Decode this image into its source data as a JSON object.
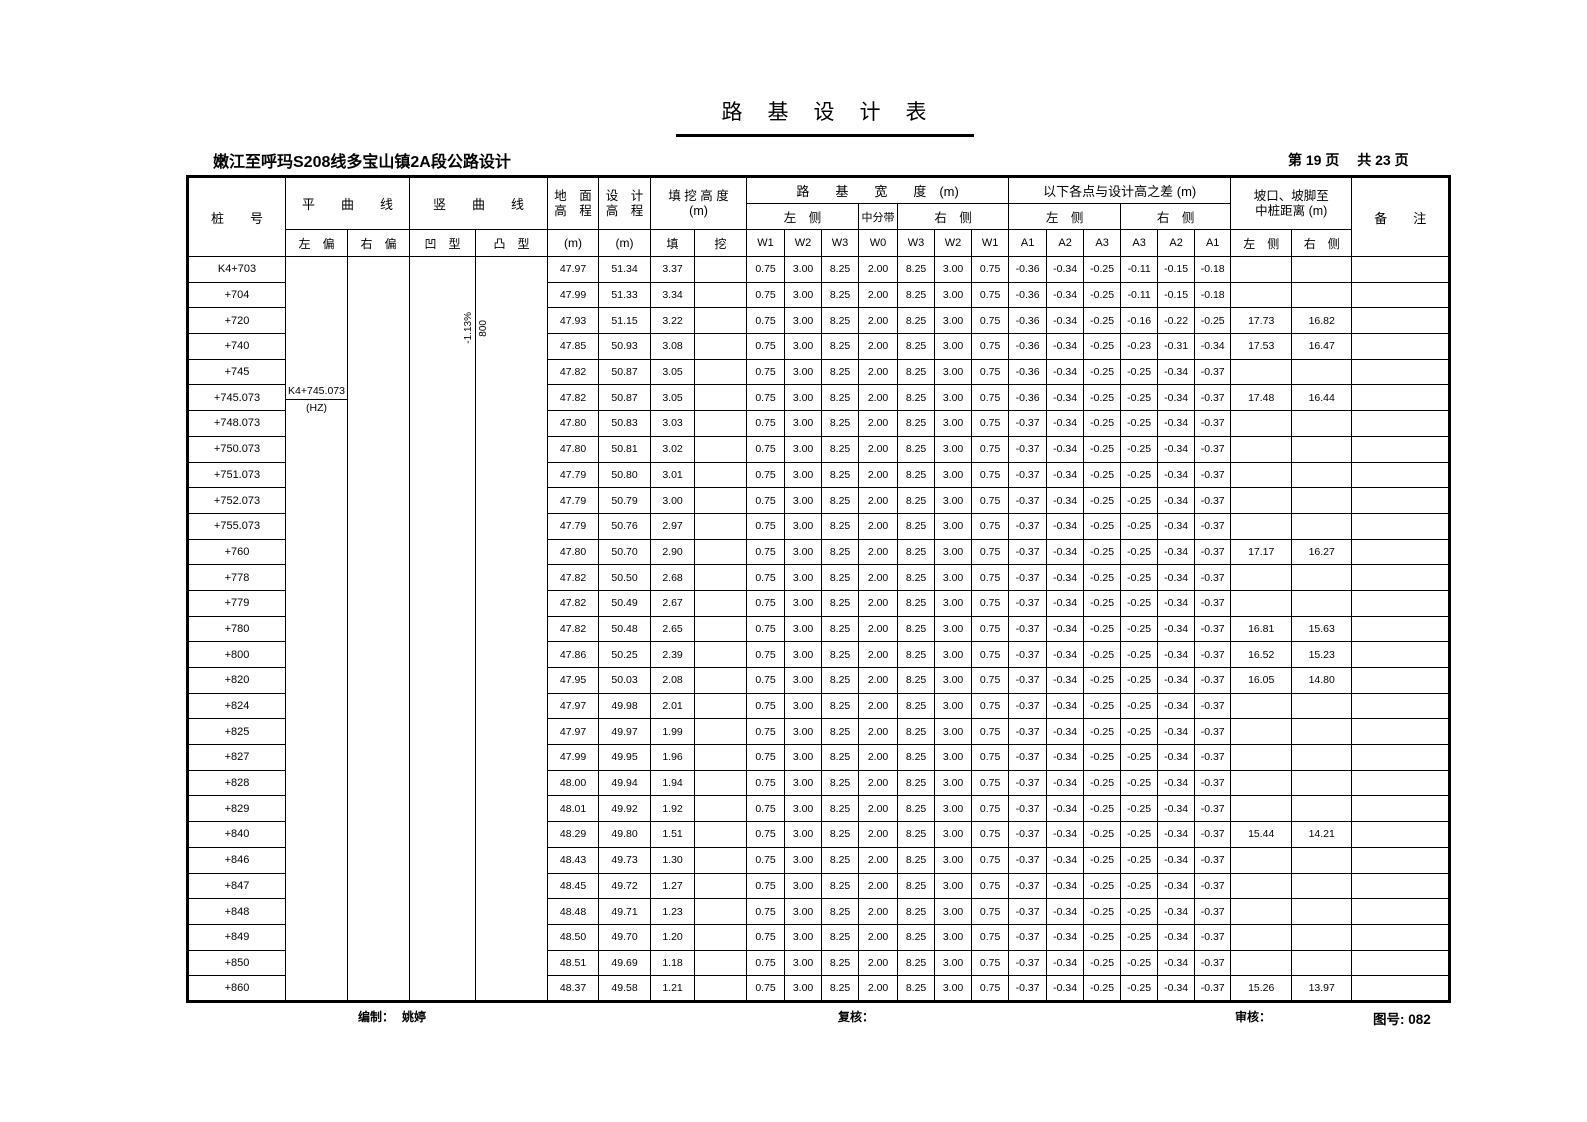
{
  "page": {
    "title": "路　基　设　计　表",
    "subtitle": "嫩江至呼玛S208线多宝山镇2A段公路设计",
    "page_info": "第 19 页　 共 23 页"
  },
  "header": {
    "stake": "桩　　号",
    "h_curve": "平　　曲　　线",
    "v_curve": "竖　　曲　　线",
    "curve_left": "左　偏",
    "curve_right": "右　偏",
    "concave": "凹　型",
    "convex": "凸　型",
    "ground_1": "地　面",
    "ground_2": "高　程",
    "design_1": "设　计",
    "design_2": "高　程",
    "unit_m": "(m)",
    "fillcut_1": "填 挖 高 度",
    "fillcut_2": "(m)",
    "fill": "填",
    "cut": "挖",
    "width_group": "路　　基　　宽　　度　(m)",
    "left_side": "左　侧",
    "median": "中分带",
    "right_side": "右　侧",
    "diff_group": "以下各点与设计高之差 (m)",
    "slope_1": "坡口、坡脚至",
    "slope_2": "中桩距离 (m)",
    "remark": "备　　注",
    "w_labels": [
      "W1",
      "W2",
      "W3",
      "W0",
      "W3",
      "W2",
      "W1"
    ],
    "a_labels": [
      "A1",
      "A2",
      "A3",
      "A3",
      "A2",
      "A1"
    ]
  },
  "annotations": {
    "hz_station": "K4+745.073",
    "hz_mark": "(HZ)",
    "vcurve_grade": "-1.13%",
    "vcurve_radius": "800"
  },
  "table": {
    "column_order": [
      "stake",
      "ground_elev_m",
      "design_elev_m",
      "fill",
      "cut",
      "W1_left",
      "W2_left",
      "W3_left",
      "W0_median",
      "W3_right",
      "W2_right",
      "W1_right",
      "A1_left",
      "A2_left",
      "A3_left",
      "A3_right",
      "A2_right",
      "A1_right",
      "slope_dist_left",
      "slope_dist_right",
      "remark"
    ],
    "rows": [
      [
        "K4+703",
        "47.97",
        "51.34",
        "3.37",
        "",
        "0.75",
        "3.00",
        "8.25",
        "2.00",
        "8.25",
        "3.00",
        "0.75",
        "-0.36",
        "-0.34",
        "-0.25",
        "-0.11",
        "-0.15",
        "-0.18",
        "",
        "",
        ""
      ],
      [
        "+704",
        "47.99",
        "51.33",
        "3.34",
        "",
        "0.75",
        "3.00",
        "8.25",
        "2.00",
        "8.25",
        "3.00",
        "0.75",
        "-0.36",
        "-0.34",
        "-0.25",
        "-0.11",
        "-0.15",
        "-0.18",
        "",
        "",
        ""
      ],
      [
        "+720",
        "47.93",
        "51.15",
        "3.22",
        "",
        "0.75",
        "3.00",
        "8.25",
        "2.00",
        "8.25",
        "3.00",
        "0.75",
        "-0.36",
        "-0.34",
        "-0.25",
        "-0.16",
        "-0.22",
        "-0.25",
        "17.73",
        "16.82",
        ""
      ],
      [
        "+740",
        "47.85",
        "50.93",
        "3.08",
        "",
        "0.75",
        "3.00",
        "8.25",
        "2.00",
        "8.25",
        "3.00",
        "0.75",
        "-0.36",
        "-0.34",
        "-0.25",
        "-0.23",
        "-0.31",
        "-0.34",
        "17.53",
        "16.47",
        ""
      ],
      [
        "+745",
        "47.82",
        "50.87",
        "3.05",
        "",
        "0.75",
        "3.00",
        "8.25",
        "2.00",
        "8.25",
        "3.00",
        "0.75",
        "-0.36",
        "-0.34",
        "-0.25",
        "-0.25",
        "-0.34",
        "-0.37",
        "",
        "",
        ""
      ],
      [
        "+745.073",
        "47.82",
        "50.87",
        "3.05",
        "",
        "0.75",
        "3.00",
        "8.25",
        "2.00",
        "8.25",
        "3.00",
        "0.75",
        "-0.36",
        "-0.34",
        "-0.25",
        "-0.25",
        "-0.34",
        "-0.37",
        "17.48",
        "16.44",
        ""
      ],
      [
        "+748.073",
        "47.80",
        "50.83",
        "3.03",
        "",
        "0.75",
        "3.00",
        "8.25",
        "2.00",
        "8.25",
        "3.00",
        "0.75",
        "-0.37",
        "-0.34",
        "-0.25",
        "-0.25",
        "-0.34",
        "-0.37",
        "",
        "",
        ""
      ],
      [
        "+750.073",
        "47.80",
        "50.81",
        "3.02",
        "",
        "0.75",
        "3.00",
        "8.25",
        "2.00",
        "8.25",
        "3.00",
        "0.75",
        "-0.37",
        "-0.34",
        "-0.25",
        "-0.25",
        "-0.34",
        "-0.37",
        "",
        "",
        ""
      ],
      [
        "+751.073",
        "47.79",
        "50.80",
        "3.01",
        "",
        "0.75",
        "3.00",
        "8.25",
        "2.00",
        "8.25",
        "3.00",
        "0.75",
        "-0.37",
        "-0.34",
        "-0.25",
        "-0.25",
        "-0.34",
        "-0.37",
        "",
        "",
        ""
      ],
      [
        "+752.073",
        "47.79",
        "50.79",
        "3.00",
        "",
        "0.75",
        "3.00",
        "8.25",
        "2.00",
        "8.25",
        "3.00",
        "0.75",
        "-0.37",
        "-0.34",
        "-0.25",
        "-0.25",
        "-0.34",
        "-0.37",
        "",
        "",
        ""
      ],
      [
        "+755.073",
        "47.79",
        "50.76",
        "2.97",
        "",
        "0.75",
        "3.00",
        "8.25",
        "2.00",
        "8.25",
        "3.00",
        "0.75",
        "-0.37",
        "-0.34",
        "-0.25",
        "-0.25",
        "-0.34",
        "-0.37",
        "",
        "",
        ""
      ],
      [
        "+760",
        "47.80",
        "50.70",
        "2.90",
        "",
        "0.75",
        "3.00",
        "8.25",
        "2.00",
        "8.25",
        "3.00",
        "0.75",
        "-0.37",
        "-0.34",
        "-0.25",
        "-0.25",
        "-0.34",
        "-0.37",
        "17.17",
        "16.27",
        ""
      ],
      [
        "+778",
        "47.82",
        "50.50",
        "2.68",
        "",
        "0.75",
        "3.00",
        "8.25",
        "2.00",
        "8.25",
        "3.00",
        "0.75",
        "-0.37",
        "-0.34",
        "-0.25",
        "-0.25",
        "-0.34",
        "-0.37",
        "",
        "",
        ""
      ],
      [
        "+779",
        "47.82",
        "50.49",
        "2.67",
        "",
        "0.75",
        "3.00",
        "8.25",
        "2.00",
        "8.25",
        "3.00",
        "0.75",
        "-0.37",
        "-0.34",
        "-0.25",
        "-0.25",
        "-0.34",
        "-0.37",
        "",
        "",
        ""
      ],
      [
        "+780",
        "47.82",
        "50.48",
        "2.65",
        "",
        "0.75",
        "3.00",
        "8.25",
        "2.00",
        "8.25",
        "3.00",
        "0.75",
        "-0.37",
        "-0.34",
        "-0.25",
        "-0.25",
        "-0.34",
        "-0.37",
        "16.81",
        "15.63",
        ""
      ],
      [
        "+800",
        "47.86",
        "50.25",
        "2.39",
        "",
        "0.75",
        "3.00",
        "8.25",
        "2.00",
        "8.25",
        "3.00",
        "0.75",
        "-0.37",
        "-0.34",
        "-0.25",
        "-0.25",
        "-0.34",
        "-0.37",
        "16.52",
        "15.23",
        ""
      ],
      [
        "+820",
        "47.95",
        "50.03",
        "2.08",
        "",
        "0.75",
        "3.00",
        "8.25",
        "2.00",
        "8.25",
        "3.00",
        "0.75",
        "-0.37",
        "-0.34",
        "-0.25",
        "-0.25",
        "-0.34",
        "-0.37",
        "16.05",
        "14.80",
        ""
      ],
      [
        "+824",
        "47.97",
        "49.98",
        "2.01",
        "",
        "0.75",
        "3.00",
        "8.25",
        "2.00",
        "8.25",
        "3.00",
        "0.75",
        "-0.37",
        "-0.34",
        "-0.25",
        "-0.25",
        "-0.34",
        "-0.37",
        "",
        "",
        ""
      ],
      [
        "+825",
        "47.97",
        "49.97",
        "1.99",
        "",
        "0.75",
        "3.00",
        "8.25",
        "2.00",
        "8.25",
        "3.00",
        "0.75",
        "-0.37",
        "-0.34",
        "-0.25",
        "-0.25",
        "-0.34",
        "-0.37",
        "",
        "",
        ""
      ],
      [
        "+827",
        "47.99",
        "49.95",
        "1.96",
        "",
        "0.75",
        "3.00",
        "8.25",
        "2.00",
        "8.25",
        "3.00",
        "0.75",
        "-0.37",
        "-0.34",
        "-0.25",
        "-0.25",
        "-0.34",
        "-0.37",
        "",
        "",
        ""
      ],
      [
        "+828",
        "48.00",
        "49.94",
        "1.94",
        "",
        "0.75",
        "3.00",
        "8.25",
        "2.00",
        "8.25",
        "3.00",
        "0.75",
        "-0.37",
        "-0.34",
        "-0.25",
        "-0.25",
        "-0.34",
        "-0.37",
        "",
        "",
        ""
      ],
      [
        "+829",
        "48.01",
        "49.92",
        "1.92",
        "",
        "0.75",
        "3.00",
        "8.25",
        "2.00",
        "8.25",
        "3.00",
        "0.75",
        "-0.37",
        "-0.34",
        "-0.25",
        "-0.25",
        "-0.34",
        "-0.37",
        "",
        "",
        ""
      ],
      [
        "+840",
        "48.29",
        "49.80",
        "1.51",
        "",
        "0.75",
        "3.00",
        "8.25",
        "2.00",
        "8.25",
        "3.00",
        "0.75",
        "-0.37",
        "-0.34",
        "-0.25",
        "-0.25",
        "-0.34",
        "-0.37",
        "15.44",
        "14.21",
        ""
      ],
      [
        "+846",
        "48.43",
        "49.73",
        "1.30",
        "",
        "0.75",
        "3.00",
        "8.25",
        "2.00",
        "8.25",
        "3.00",
        "0.75",
        "-0.37",
        "-0.34",
        "-0.25",
        "-0.25",
        "-0.34",
        "-0.37",
        "",
        "",
        ""
      ],
      [
        "+847",
        "48.45",
        "49.72",
        "1.27",
        "",
        "0.75",
        "3.00",
        "8.25",
        "2.00",
        "8.25",
        "3.00",
        "0.75",
        "-0.37",
        "-0.34",
        "-0.25",
        "-0.25",
        "-0.34",
        "-0.37",
        "",
        "",
        ""
      ],
      [
        "+848",
        "48.48",
        "49.71",
        "1.23",
        "",
        "0.75",
        "3.00",
        "8.25",
        "2.00",
        "8.25",
        "3.00",
        "0.75",
        "-0.37",
        "-0.34",
        "-0.25",
        "-0.25",
        "-0.34",
        "-0.37",
        "",
        "",
        ""
      ],
      [
        "+849",
        "48.50",
        "49.70",
        "1.20",
        "",
        "0.75",
        "3.00",
        "8.25",
        "2.00",
        "8.25",
        "3.00",
        "0.75",
        "-0.37",
        "-0.34",
        "-0.25",
        "-0.25",
        "-0.34",
        "-0.37",
        "",
        "",
        ""
      ],
      [
        "+850",
        "48.51",
        "49.69",
        "1.18",
        "",
        "0.75",
        "3.00",
        "8.25",
        "2.00",
        "8.25",
        "3.00",
        "0.75",
        "-0.37",
        "-0.34",
        "-0.25",
        "-0.25",
        "-0.34",
        "-0.37",
        "",
        "",
        ""
      ],
      [
        "+860",
        "48.37",
        "49.58",
        "1.21",
        "",
        "0.75",
        "3.00",
        "8.25",
        "2.00",
        "8.25",
        "3.00",
        "0.75",
        "-0.37",
        "-0.34",
        "-0.25",
        "-0.25",
        "-0.34",
        "-0.37",
        "15.26",
        "13.97",
        ""
      ]
    ]
  },
  "footer": {
    "compile_label": "编制：",
    "compile_name": "姚婷",
    "review_label": "复核：",
    "audit_label": "审核：",
    "drawing_label": "图号: ",
    "drawing_no": "082"
  }
}
